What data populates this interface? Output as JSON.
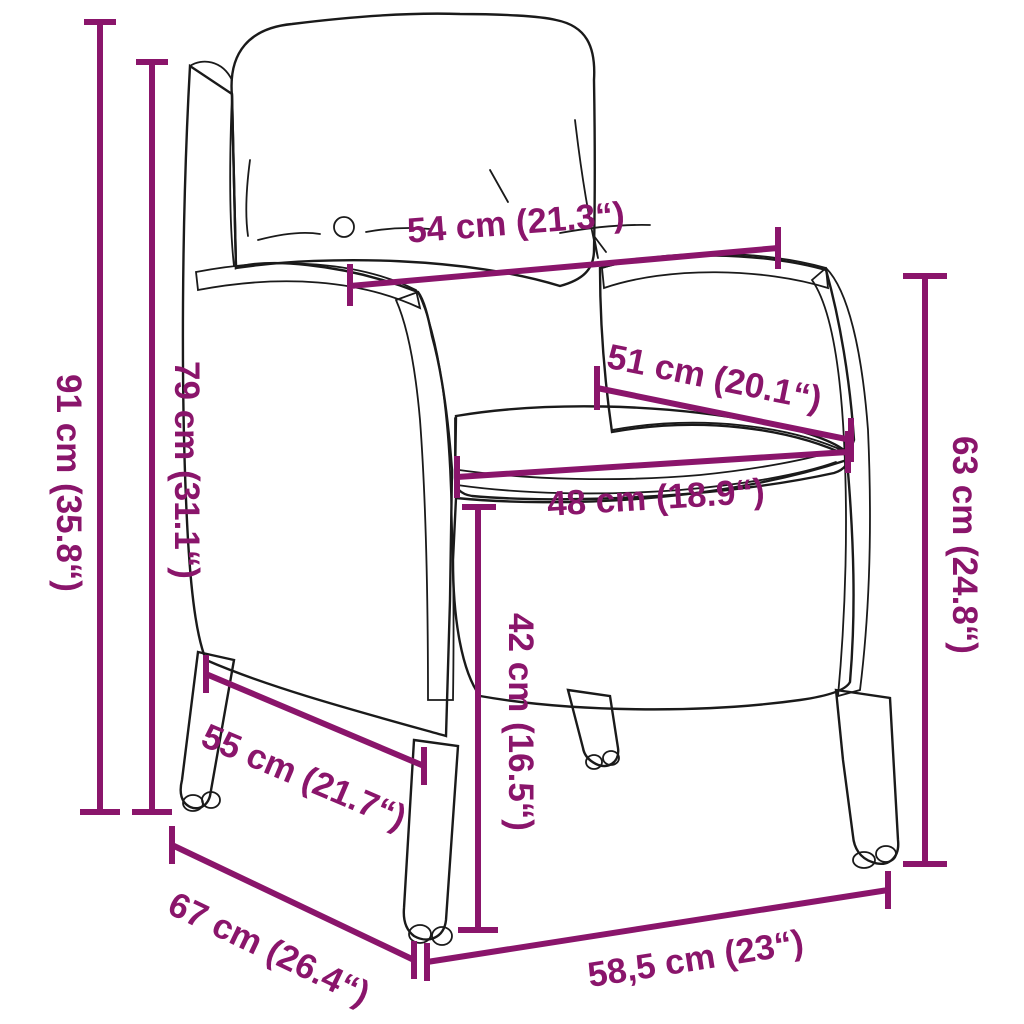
{
  "diagram": {
    "kind": "product-dimension-diagram",
    "subject": "rattan garden armchair with back and seat cushions",
    "background_color": "#FFFFFF",
    "drawing_color": "#1A1A1A",
    "accent_color": "#8A156B",
    "dimensions": [
      {
        "id": "total-height",
        "label": "91 cm (35.8“)",
        "value_cm": 91,
        "value_inch": 35.8,
        "orientation": "vertical"
      },
      {
        "id": "backrest-height",
        "label": "79 cm (31.1“)",
        "value_cm": 79,
        "value_inch": 31.1,
        "orientation": "vertical"
      },
      {
        "id": "backrest-width",
        "label": "54 cm (21.3“)",
        "value_cm": 54,
        "value_inch": 21.3,
        "orientation": "horizontal"
      },
      {
        "id": "seat-depth",
        "label": "51 cm (20.1“)",
        "value_cm": 51,
        "value_inch": 20.1,
        "orientation": "diagonal"
      },
      {
        "id": "seat-width",
        "label": "48 cm (18.9“)",
        "value_cm": 48,
        "value_inch": 18.9,
        "orientation": "horizontal"
      },
      {
        "id": "armrest-height",
        "label": "63 cm (24.8“)",
        "value_cm": 63,
        "value_inch": 24.8,
        "orientation": "vertical"
      },
      {
        "id": "seat-height",
        "label": "42 cm (16.5“)",
        "value_cm": 42,
        "value_inch": 16.5,
        "orientation": "vertical"
      },
      {
        "id": "side-depth",
        "label": "55 cm (21.7“)",
        "value_cm": 55,
        "value_inch": 21.7,
        "orientation": "diagonal"
      },
      {
        "id": "total-depth",
        "label": "67 cm (26.4“)",
        "value_cm": 67,
        "value_inch": 26.4,
        "orientation": "diagonal"
      },
      {
        "id": "base-width",
        "label": "58,5 cm (23“)",
        "value_cm": 58.5,
        "value_inch": 23,
        "orientation": "horizontal"
      }
    ]
  }
}
